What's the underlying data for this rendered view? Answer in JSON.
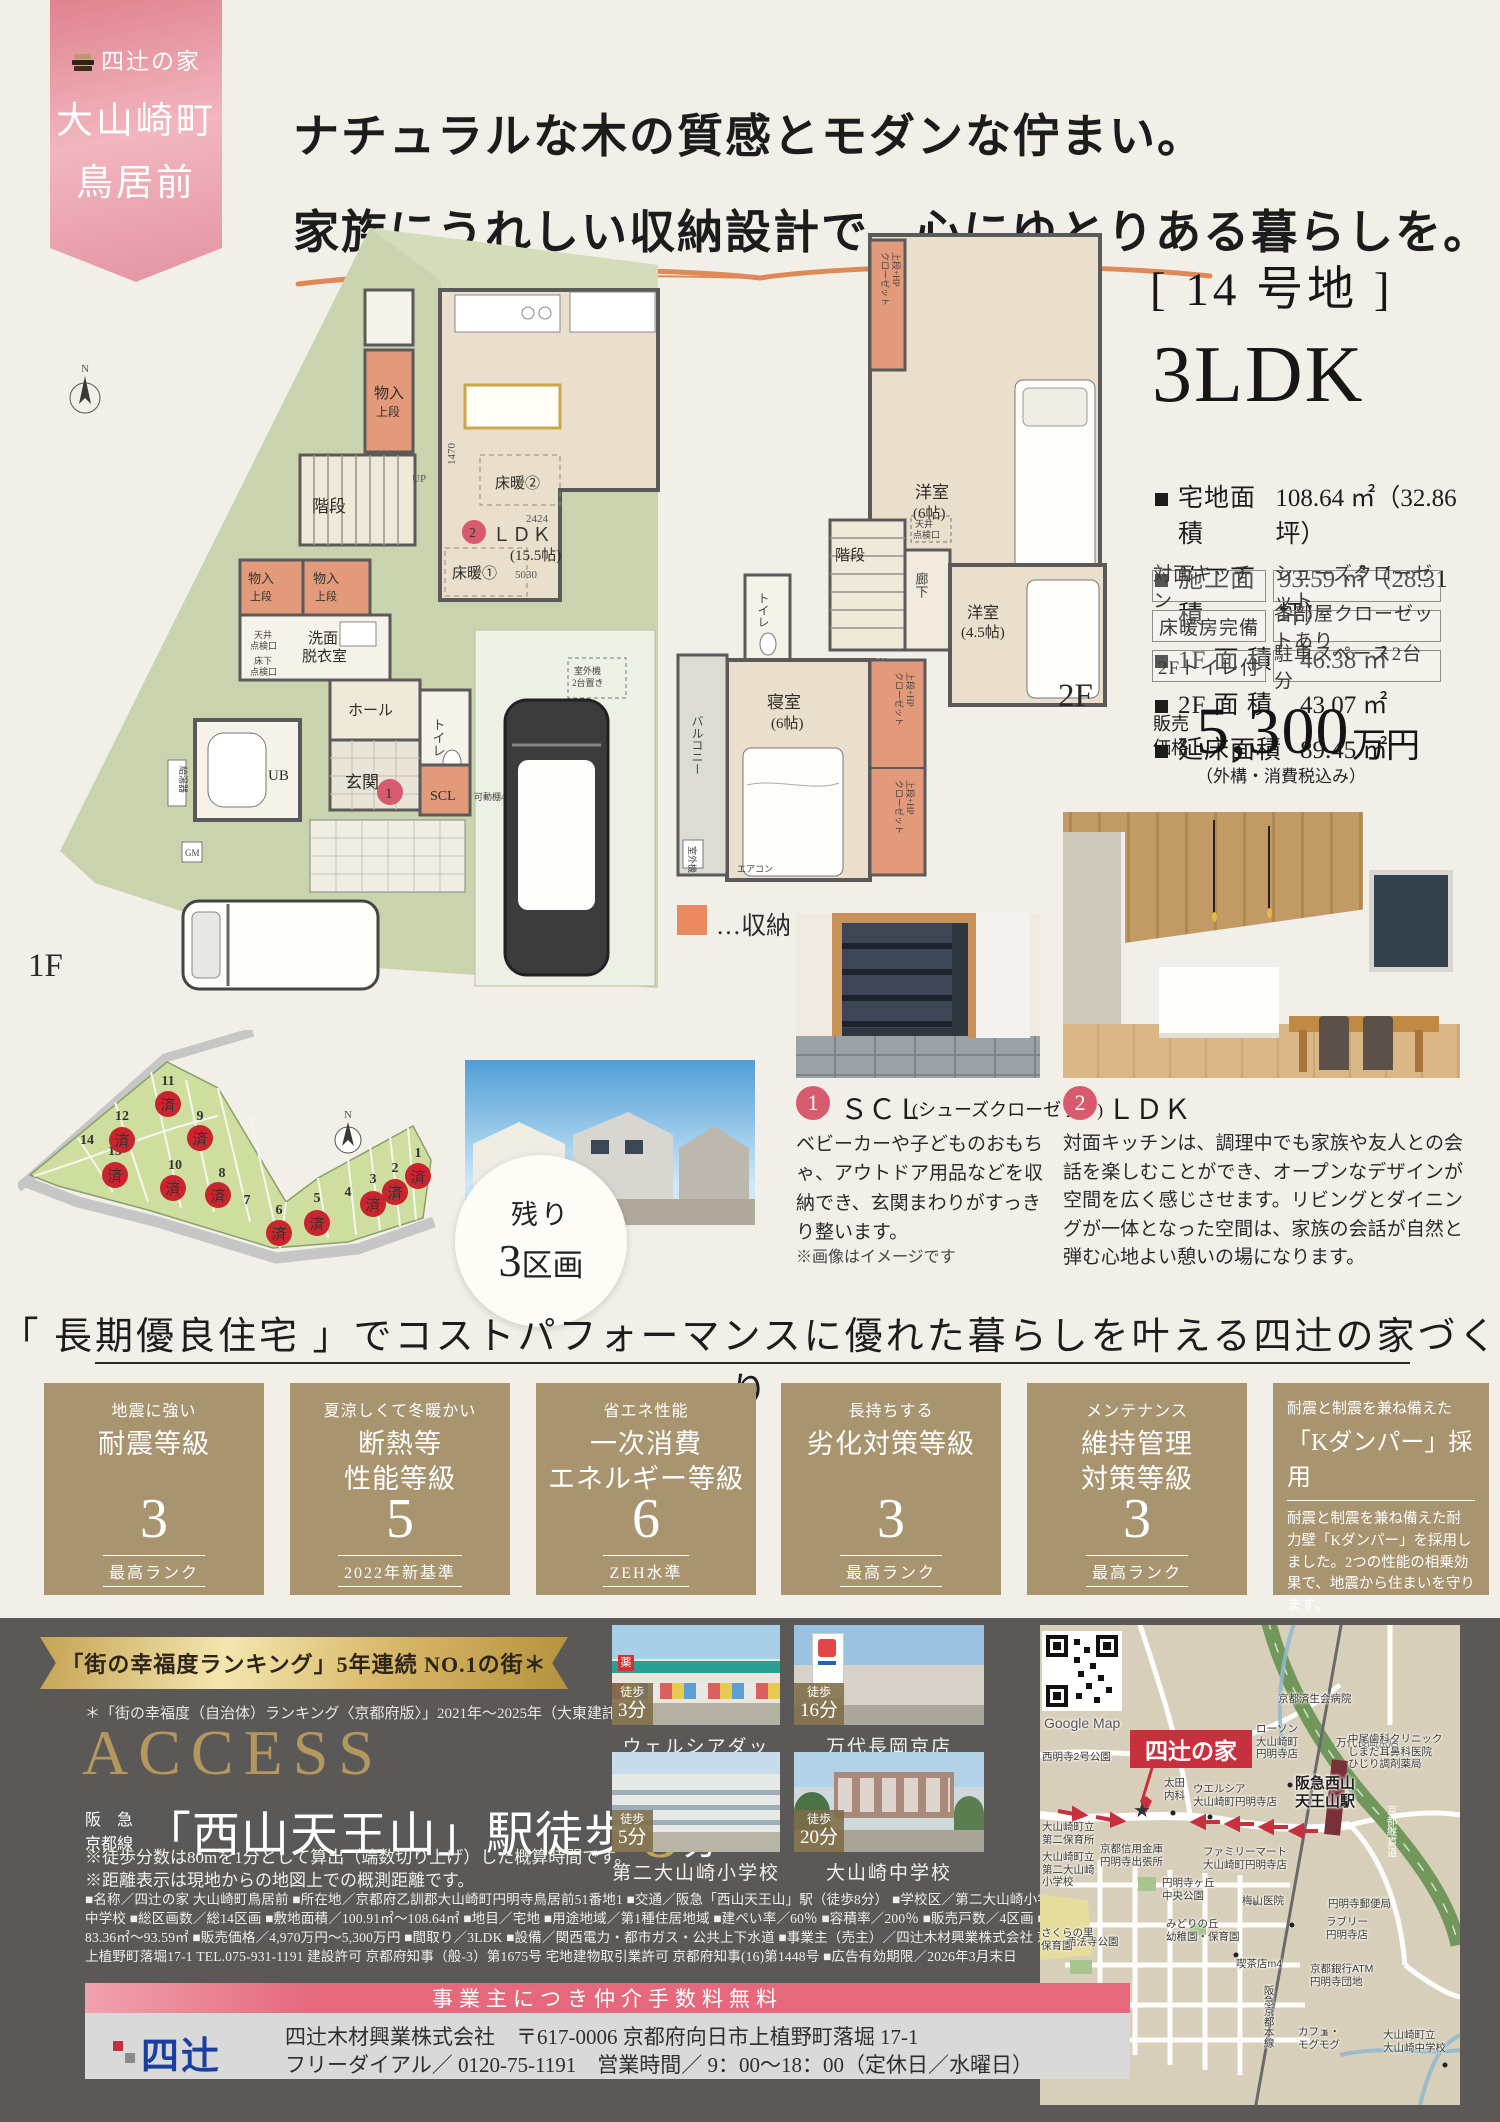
{
  "ribbon": {
    "brand": "四辻の家",
    "town": "大山崎町",
    "area": "鳥居前"
  },
  "headline": {
    "line1": "ナチュラルな木の質感とモダンな佇まい。",
    "line2": "家族にうれしい収納設計で、心にゆとりある暮らしを。"
  },
  "property": {
    "lot": "[ 14 号地 ]",
    "plan": "3LDK",
    "specs": [
      {
        "label": "宅地面積",
        "value": "108.64 ㎡（32.86 坪）"
      },
      {
        "label": "施工面積",
        "value": "93.59 ㎡（28.31 坪）"
      },
      {
        "label": "1F 面 積",
        "value": "46.38 ㎡"
      },
      {
        "label": "2F 面 積",
        "value": "43.07 ㎡"
      },
      {
        "label": "延床面積",
        "value": "89.45 ㎡"
      }
    ],
    "tags": [
      "対面キッチン",
      "シューズクローゼット",
      "床暖房完備",
      "各部屋クローゼットあり",
      "2Fトイレ付",
      "駐車スペース2台分"
    ],
    "price": {
      "label": "販売\n価格",
      "value": "5,300",
      "unit": "万円",
      "note": "（外構・消費税込み）"
    }
  },
  "plan1f": {
    "floor": "1F",
    "monoire": "物入",
    "jodan": "上段",
    "kaidan": "階段",
    "up": "UP",
    "ldk": "ＬＤＫ",
    "ldk_size": "(15.5帖)",
    "dim_w": "2424",
    "dim_h": "5030",
    "dim_k": "1470",
    "yukadan1": "床暖①",
    "yukadan2": "床暖②",
    "senmen1": "洗面",
    "senmen2": "脱衣室",
    "tenkenc1": "天井",
    "tenkenc2": "点検口",
    "tenkenf1": "床下",
    "tenkenf2": "点検口",
    "hall": "ホール",
    "toilet": "トイレ",
    "ub": "UB",
    "genkan": "玄関",
    "scl": "SCL",
    "kadana": "可動棚450×8枚",
    "gaiki1": "室外機",
    "gaiki2": "2台置き",
    "kyutoki": "給湯器",
    "gm": "GM",
    "north": "N"
  },
  "plan2f": {
    "floor": "2F",
    "y6": "洋室",
    "y6s": "(6帖)",
    "y45": "洋室",
    "y45s": "(4.5帖)",
    "master": "寝室",
    "masters": "(6帖)",
    "kaidan": "階段",
    "rouka": "廊下",
    "toilet": "トイレ",
    "balcony": "バルコニー",
    "dn": "DN",
    "tenken1": "天井",
    "tenken2": "点検口",
    "closet1": "上段+HP",
    "closet2": "クローゼット",
    "aircon": "エアコン",
    "gaiki": "室外機"
  },
  "legend": {
    "storage": "…収納"
  },
  "lotmap": {
    "remaining1": "残り",
    "remaining2": "3",
    "remaining3": "区画",
    "sold": "済",
    "north": "N",
    "lots": [
      {
        "no": "1",
        "sold": true
      },
      {
        "no": "2",
        "sold": true
      },
      {
        "no": "3",
        "sold": true
      },
      {
        "no": "4",
        "sold": false
      },
      {
        "no": "5",
        "sold": true
      },
      {
        "no": "6",
        "sold": true
      },
      {
        "no": "7",
        "sold": false
      },
      {
        "no": "8",
        "sold": true
      },
      {
        "no": "9",
        "sold": true
      },
      {
        "no": "10",
        "sold": true
      },
      {
        "no": "11",
        "sold": true
      },
      {
        "no": "12",
        "sold": true
      },
      {
        "no": "13",
        "sold": true
      },
      {
        "no": "14",
        "sold": false
      }
    ]
  },
  "features": {
    "point1": {
      "num": "1",
      "title": "ＳＣＬ",
      "sub": "(シューズクローゼット)",
      "desc": "ベビーカーや子どものおもちゃ、アウトドア用品などを収納でき、玄関まわりがすっきり整います。",
      "note": "※画像はイメージです"
    },
    "point2": {
      "num": "2",
      "title": "ＬＤＫ",
      "desc": "対面キッチンは、調理中でも家族や友人との会話を楽しむことができ、オープンなデザインが空間を広く感じさせます。リビングとダイニングが一体となった空間は、家族の会話が自然と弾む心地よい憩いの場になります。"
    }
  },
  "banner": {
    "text": "「 長期優良住宅 」でコストパフォーマンスに優れた暮らしを叶える四辻の家づくり"
  },
  "ratings": [
    {
      "sub": "地震に強い",
      "title": "耐震等級",
      "value": "3",
      "note": "最高ランク"
    },
    {
      "sub": "夏涼しくて冬暖かい",
      "title": "断熱等\n性能等級",
      "value": "5",
      "note": "2022年新基準"
    },
    {
      "sub": "省エネ性能",
      "title": "一次消費\nエネルギー等級",
      "value": "6",
      "note": "ZEH水準"
    },
    {
      "sub": "長持ちする",
      "title": "劣化対策等級",
      "value": "3",
      "note": "最高ランク"
    },
    {
      "sub": "メンテナンス",
      "title": "維持管理\n対策等級",
      "value": "3",
      "note": "最高ランク"
    }
  ],
  "kdamper": {
    "sub": "耐震と制震を兼ね備えた",
    "title": "「Kダンパー」採用",
    "desc": "耐震と制震を兼ね備えた耐力壁「Kダンパー」を採用しました。2つの性能の相乗効果で、地震から住まいを守ります。"
  },
  "access": {
    "ribbon": "「街の幸福度ランキング」5年連続 NO.1の街＊",
    "footnote": "＊「街の幸福度（自治体）ランキング〈京都府版〉」2021年～2025年（大東建託株式会社）",
    "title": "ACCESS",
    "line1": "阪　急",
    "line2": "京都線",
    "station": "「西山天王山」駅徒歩",
    "minutes": "8",
    "unit": "分",
    "note1": "※徒歩分数は80mを1分として算出（端数切り上げ）した概算時間です。",
    "note2": "※距離表示は現地からの地図上での概測距離です。",
    "fineprint": "■名称／四辻の家 大山崎町鳥居前 ■所在地／京都府乙訓郡大山崎町円明寺鳥居前51番地1 ■交通／阪急「西山天王山」駅（徒歩8分） ■学校区／第二大山崎小学校、大山崎中学校 ■総区画数／総14区画 ■敷地面積／100.91㎡～108.64㎡ ■地目／宅地 ■用途地域／第1種住居地域 ■建ぺい率／60％ ■容積率／200％ ■販売戸数／4区画 ■建物面積83.36㎡～93.59㎡ ■販売価格／4,970万円～5,300万円 ■間取り／3LDK ■設備／関西電力・都市ガス・公共上下水道 ■事業主（売主）／四辻木材興業株式会社 京都府向日市上植野町落堀17-1 TEL.075-931-1191 建設許可 京都府知事（般-3）第1675号 宅地建物取引業許可 京都府知事(16)第1448号 ■広告有効期限／2026年3月末日"
  },
  "places": [
    {
      "walk": "徒歩",
      "min": "3分",
      "name": "ウェルシアダックス"
    },
    {
      "walk": "徒歩",
      "min": "16分",
      "name": "万代長岡京店"
    },
    {
      "walk": "徒歩",
      "min": "5分",
      "name": "第二大山崎小学校"
    },
    {
      "walk": "徒歩",
      "min": "20分",
      "name": "大山崎中学校"
    }
  ],
  "map": {
    "google": "Google Map",
    "home": "四辻の家",
    "station": "阪急西山\n天王山駅",
    "rail": "阪急京都本線",
    "highway": "京都縦貫道",
    "labels": [
      {
        "text": "京都済生会病院"
      },
      {
        "text": "万代長岡京店"
      },
      {
        "text": "西明寺2号公園"
      },
      {
        "text": "ローソン\n大山崎町\n円明寺店"
      },
      {
        "text": "中尾歯科クリニック\nしまだ耳鼻科医院\nひじり調剤薬局"
      },
      {
        "text": "太田\n内科"
      },
      {
        "text": "ウエルシア\n大山崎町円明寺店"
      },
      {
        "text": "大山崎町立\n第二保育所"
      },
      {
        "text": "京都信用金庫\n円明寺出張所"
      },
      {
        "text": "ファミリーマート\n大山崎町円明寺店"
      },
      {
        "text": "大山崎町立\n第二大山崎\n小学校"
      },
      {
        "text": "円明寺ヶ丘\n中央公園"
      },
      {
        "text": "梅山医院"
      },
      {
        "text": "円明寺郵便局"
      },
      {
        "text": "みどりの丘\n幼稚園・保育園"
      },
      {
        "text": "ラブリー\n円明寺店"
      },
      {
        "text": "西法寺公園"
      },
      {
        "text": "さくらの里\n保育園"
      },
      {
        "text": "喫茶店m4"
      },
      {
        "text": "京都銀行ATM\n円明寺団地"
      },
      {
        "text": "カフェ・\nモグモグ"
      },
      {
        "text": "大山崎町立\n大山崎中学校"
      }
    ]
  },
  "footer": {
    "banner": "事業主につき仲介手数料無料",
    "logo": "四辻",
    "line1": "四辻木材興業株式会社　〒617-0006 京都府向日市上植野町落堀 17-1",
    "line2": "フリーダイアル／ 0120-75-1191　営業時間／ 9：00～18：00（定休日／水曜日）"
  }
}
